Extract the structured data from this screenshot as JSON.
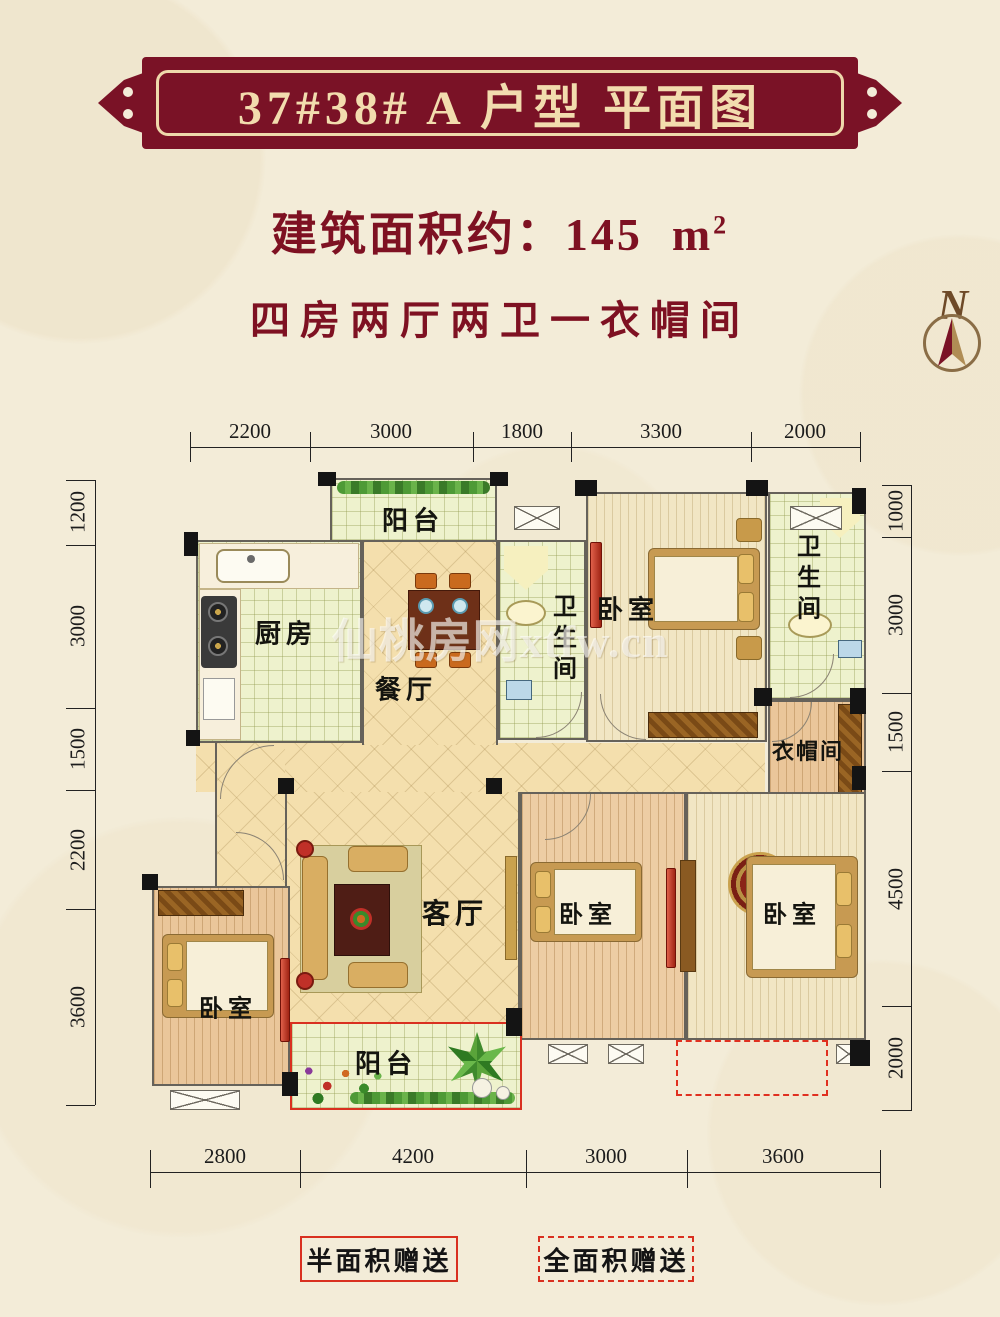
{
  "header": {
    "banner_title": "37#38# A 户型 平面图",
    "area_prefix": "建筑面积约：",
    "area_value": "145",
    "area_unit": "m",
    "area_exponent": "2",
    "layout_desc": "四房两厅两卫一衣帽间",
    "compass_letter": "N"
  },
  "colors": {
    "banner_bg": "#7a1226",
    "banner_text": "#f2dcae",
    "subtitle_red": "#7e1122",
    "gift_red": "#d93020",
    "background_cream": "#f3ecd8"
  },
  "plan": {
    "watermark": "仙桃房网xtfw.cn",
    "rooms": {
      "balcony_north": "阳台",
      "kitchen": "厨房",
      "dining": "餐厅",
      "bath_a": "卫生间",
      "bedroom_north": "卧室",
      "bath_b": "卫生间",
      "cloakroom": "衣帽间",
      "living": "客厅",
      "bedroom_west": "卧室",
      "bedroom_south": "卧室",
      "bedroom_southeast": "卧室",
      "balcony_south": "阳台"
    },
    "dims": {
      "top": [
        "2200",
        "3000",
        "1800",
        "3300",
        "2000"
      ],
      "left": [
        "1200",
        "3000",
        "1500",
        "2200",
        "3600"
      ],
      "right": [
        "1000",
        "3000",
        "1500",
        "4500",
        "2000"
      ],
      "bottom": [
        "2800",
        "4200",
        "3000",
        "3600"
      ]
    }
  },
  "legend": {
    "half": "半面积赠送",
    "full": "全面积赠送"
  }
}
